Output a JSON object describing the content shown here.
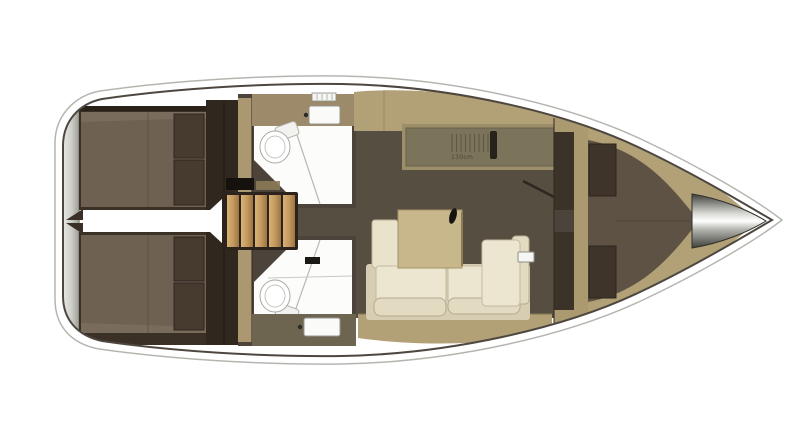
{
  "title": "Sailing yacht interior layout plan (top-down deck plan, bow to the right)",
  "labels": {
    "galley_dimension": "130cm"
  },
  "regions": {
    "stern": "transom swim platform",
    "aft_port": "aft double cabin (top)",
    "aft_starboard": "aft double cabin (bottom)",
    "center": "companionway stairs between two heads",
    "midship": "galley (top), saloon with table and L-sofa (bottom)",
    "forward": "forward V-berth cabin",
    "bow": "anchor / bow fitting cone"
  },
  "palette": {
    "hull_outline": "#4d473f",
    "outer_guide_line": "#b5b5b0",
    "deck_white": "#ffffff",
    "transom_gray": "#9e9e97",
    "cabin_wall": "#30281f",
    "cabin_base": "#3a3025",
    "berth_brown": "#6e6152",
    "pillow_brown": "#473a2e",
    "wood_tan": "#b2a176",
    "wood_wall": "#ab9a70",
    "stair_wood": "#c49a5e",
    "stair_frame": "#2c241c",
    "floor_taupe": "#574e42",
    "head_wall_olive": "#4c433a",
    "fixture_white": "#fcfcfa",
    "sink_band_olive": "#6e6550",
    "galley_counter": "#9b8e68",
    "worktop_olive": "#7b735a",
    "sofa_cream": "#ece6d0",
    "sofa_base": "#d6cdb2",
    "table_wood": "#c9b78c",
    "vberth_brown": "#5e5245",
    "bow_metal": "#3f3f3b"
  }
}
